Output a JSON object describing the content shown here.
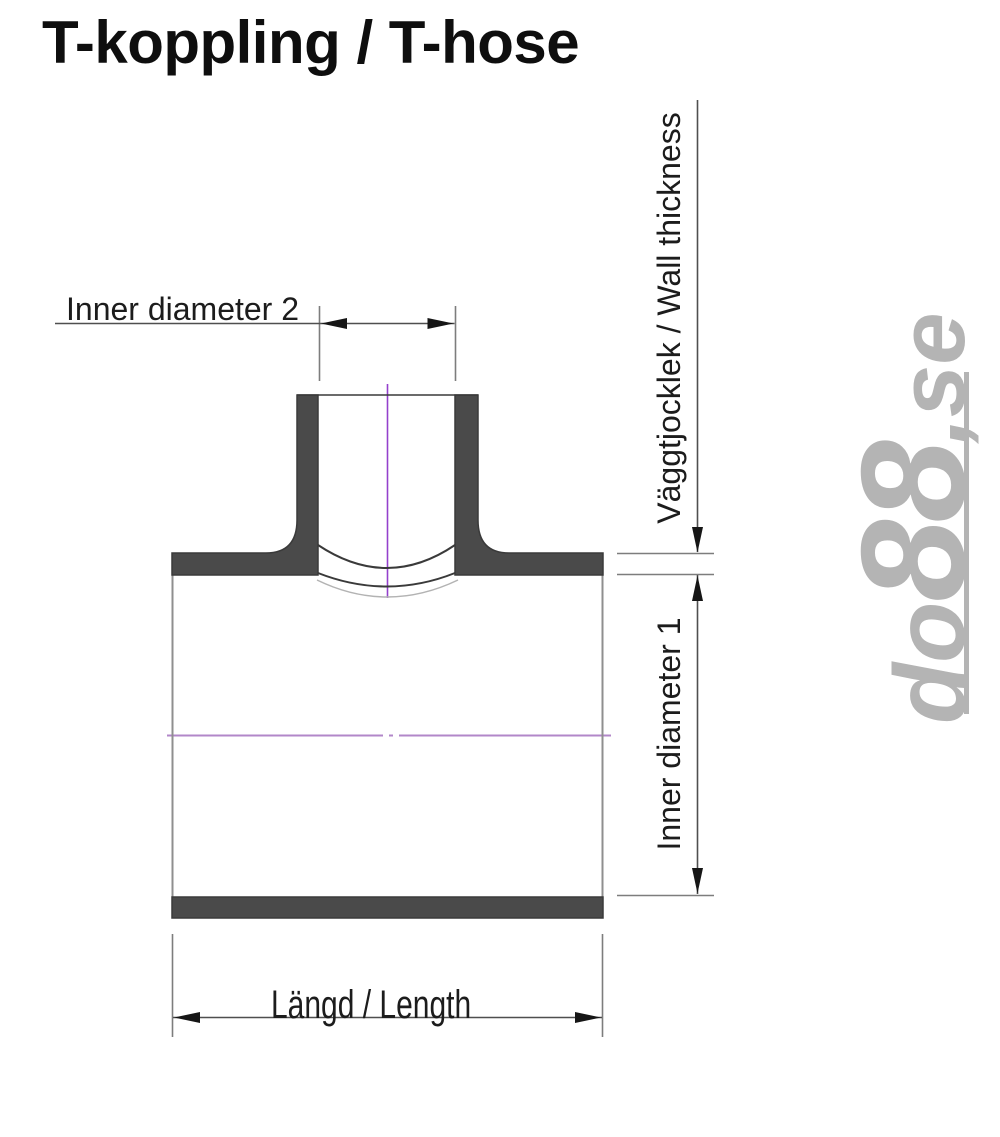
{
  "page": {
    "title": "T-koppling / T-hose"
  },
  "dimensions": {
    "inner_diameter_2": {
      "label": "Inner diameter 2"
    },
    "wall_thickness": {
      "label": "Väggtjocklek / Wall thickness"
    },
    "inner_diameter_1": {
      "label": "Inner diameter 1"
    },
    "length": {
      "label": "Längd / Length"
    }
  },
  "watermark": {
    "prefix": "do",
    "number": "88",
    "suffix": ",se",
    "color": "#b4b4b4"
  },
  "colors": {
    "background": "#ffffff",
    "title_text": "#0e0e0e",
    "label_text": "#1c1c1c",
    "wall_fill": "#4a4a4a",
    "wall_outline": "#3a3a3a",
    "body_edge": "#8f8f8f",
    "saddle_dark": "#3a3a3a",
    "saddle_light": "#b3b3b3",
    "dim_line": "#4f4f4f",
    "ext_line": "#7d7d7d",
    "arrow": "#161616",
    "centerline_vertical": "#9440cc",
    "centerline_horizontal": "#b287c9"
  }
}
